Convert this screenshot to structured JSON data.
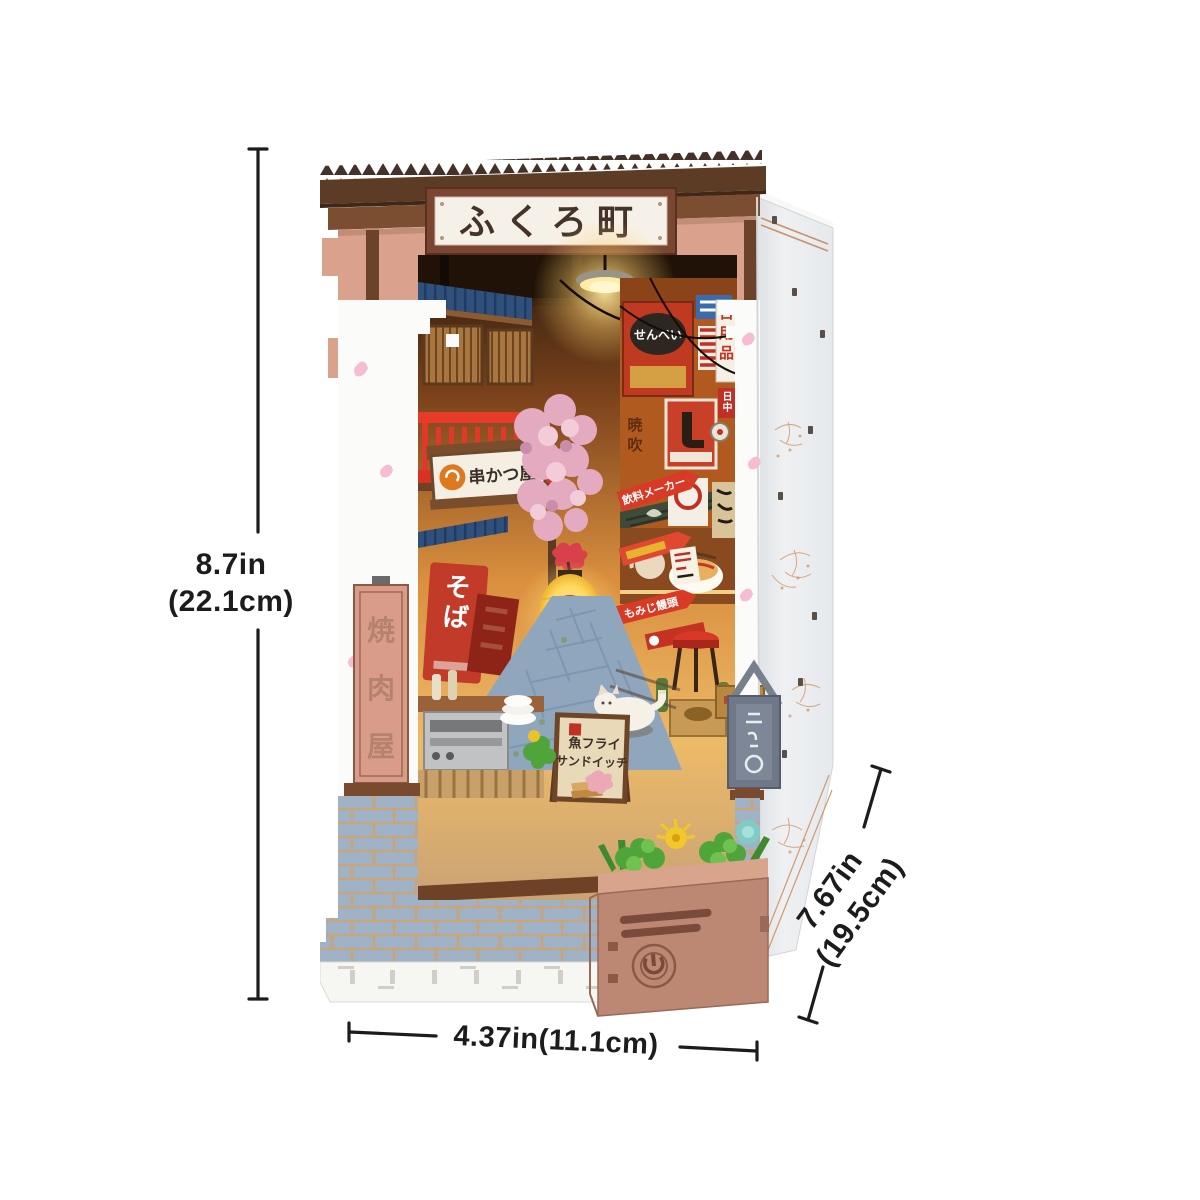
{
  "product": {
    "name": "japanese-alley-book-nook-miniature",
    "roof_sign": "ふくろ町",
    "left_pillar_sign": "焼肉屋",
    "soba_banner": "そば",
    "shop_sign": "串かつ屋",
    "senbei_sign": "せんべい",
    "daily_goods_sign": "日用品",
    "small_red_sign": "日中",
    "drink_maker_sign": "飲料メーカー",
    "momiji_sign": "もみじ饅頭",
    "aframe_sign_line1": "魚フライ",
    "aframe_sign_line2": "サンドイッチ",
    "wall_text": "暁吹"
  },
  "dimensions": {
    "height_in": "8.7in",
    "height_cm": "(22.1cm)",
    "width_label": "4.37in(11.1cm)",
    "depth_in": "7.67in",
    "depth_cm": "(19.5cm)"
  },
  "colors": {
    "background": "#ffffff",
    "dimension_text": "#1c1c1c",
    "roof_brown": "#5d3c26",
    "facade_salmon": "#d9a08c",
    "accent_red": "#d93a26",
    "lantern_yellow": "#ffe98c",
    "brick_blue": "#9fb2c6",
    "planter_wood": "#bc8874",
    "side_panel": "#eceef0"
  }
}
